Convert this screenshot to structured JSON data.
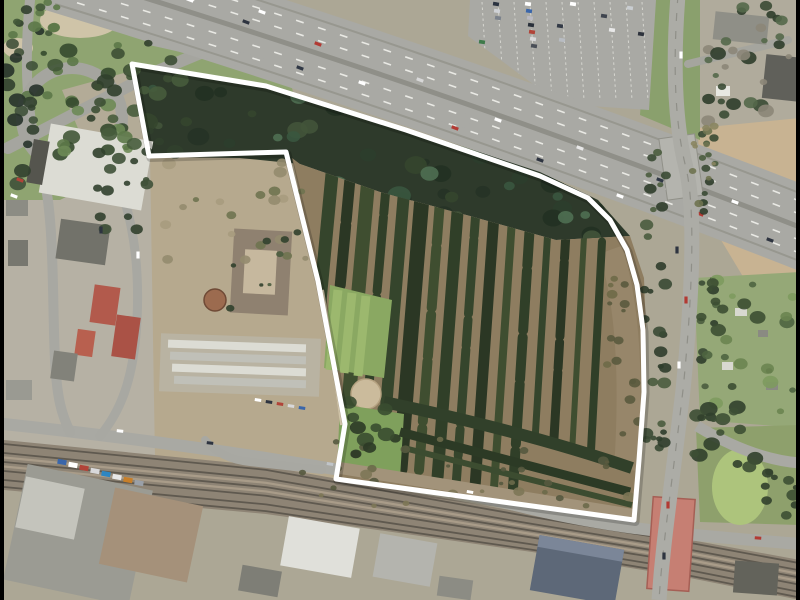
{
  "scene": {
    "type": "aerial-orthophoto",
    "description": "Aerial photo of a former tree-nursery site outlined with a white boundary, bordered by a motorway to the north, an arterial road to the east, a railway line to the south and an industrial quarter to the west",
    "boundary_color": "#ffffff",
    "letterbox_color": "#000000"
  },
  "colors": {
    "land": "#aca795",
    "urban": "#b6b1a4",
    "road": "#a9a9a3",
    "road_light": "#b4b4ae",
    "lane": "#e9e9e4",
    "highway": "#a9a9a4",
    "median": "#8f8f88",
    "edge": "#97978f",
    "rail_band": "#8e8475",
    "rail_track": "#5f594f",
    "rail_light": "#a99c89",
    "forest": "#2e3a2b",
    "soil": "#8e7d60",
    "scrub": "#b6a98e",
    "scrub_dark": "#a2937a",
    "grass": "#8fa471",
    "lawn": "#7fa05c",
    "lawn_bright": "#adc47c",
    "grass_row": "#9cb86e",
    "tan_field": "#c8b392",
    "allotment": "#95a877",
    "beige": "#cfc4a8",
    "parking": "#a9a9a4",
    "stall": "#d6d6d0",
    "red_bridge": "#c67f73",
    "red_bridge_edge": "#a55f55",
    "white_roof": "#dcdcd4",
    "gray_roof": "#9b9b93",
    "dark_roof": "#72726a",
    "red_roof": "#b25a4c",
    "blue_roof": "#5d6878",
    "demo_roof": "#a5917a",
    "court_roof": "#8f8170",
    "court_yard": "#c6b89e",
    "circle_sand": "#cbbb9c",
    "path": "#cfc3a8",
    "gravel": "#b3ab97"
  },
  "boundary": {
    "points": [
      [
        132,
        64
      ],
      [
        266,
        86
      ],
      [
        406,
        130
      ],
      [
        540,
        176
      ],
      [
        588,
        198
      ],
      [
        610,
        220
      ],
      [
        627,
        250
      ],
      [
        637,
        285
      ],
      [
        643,
        330
      ],
      [
        644,
        392
      ],
      [
        639,
        460
      ],
      [
        634,
        520
      ],
      [
        336,
        479
      ],
      [
        345,
        424
      ],
      [
        318,
        281
      ],
      [
        286,
        152
      ],
      [
        149,
        156
      ]
    ]
  },
  "highway": {
    "center_path": "M55,-30 C300,45 540,125 820,235",
    "width": 82,
    "dash_offsets": [
      -26,
      -13,
      13,
      26
    ],
    "edge_offsets": [
      -34,
      34
    ],
    "vehicles": [
      {
        "x": 190,
        "y": 0,
        "c": "#ffffff"
      },
      {
        "x": 246,
        "y": 22,
        "c": "#2e3440"
      },
      {
        "x": 262,
        "y": 12,
        "c": "#ffffff"
      },
      {
        "x": 318,
        "y": 44,
        "c": "#b23a33"
      },
      {
        "x": 300,
        "y": 68,
        "c": "#303845"
      },
      {
        "x": 362,
        "y": 83,
        "c": "#ffffff"
      },
      {
        "x": 420,
        "y": 80,
        "c": "#d8d8d8"
      },
      {
        "x": 455,
        "y": 128,
        "c": "#b23a33"
      },
      {
        "x": 498,
        "y": 120,
        "c": "#ffffff"
      },
      {
        "x": 540,
        "y": 160,
        "c": "#2e3440"
      },
      {
        "x": 580,
        "y": 148,
        "c": "#e8e8e8"
      },
      {
        "x": 620,
        "y": 196,
        "c": "#ffffff"
      },
      {
        "x": 660,
        "y": 180,
        "c": "#303845"
      },
      {
        "x": 700,
        "y": 214,
        "c": "#b23a33"
      },
      {
        "x": 735,
        "y": 202,
        "c": "#ffffff"
      },
      {
        "x": 770,
        "y": 240,
        "c": "#2e3440"
      }
    ]
  },
  "railway": {
    "north": [
      [
        4,
        440
      ],
      [
        266,
        466
      ],
      [
        532,
        514
      ],
      [
        680,
        538
      ],
      [
        800,
        560
      ]
    ],
    "south": [
      [
        4,
        490
      ],
      [
        266,
        514
      ],
      [
        532,
        552
      ],
      [
        680,
        576
      ],
      [
        800,
        600
      ]
    ],
    "dark_fractions": [
      0.08,
      0.26,
      0.44,
      0.62,
      0.8,
      0.94
    ],
    "light_fractions": [
      0.35,
      0.53
    ]
  },
  "nursery_rows": {
    "count": 16,
    "top": [
      332,
      174
    ],
    "top_step": [
      18.0,
      4.5
    ],
    "bot": [
      306,
      450
    ],
    "bot_step": [
      18.8,
      3.8
    ],
    "widths": [
      13,
      11,
      14,
      9,
      12,
      15,
      10,
      12,
      9,
      11,
      8,
      10,
      7,
      9,
      6,
      8
    ],
    "colors": [
      "#35452c",
      "#2b3724",
      "#3f4e30",
      "#303f28"
    ],
    "dashes": [
      "",
      "42 5 60 7",
      "",
      "26 4 74 6",
      ""
    ],
    "shorten_from": 12,
    "shorten_t": 0.78
  },
  "parking": {
    "polygon": [
      [
        470,
        0
      ],
      [
        656,
        0
      ],
      [
        649,
        110
      ],
      [
        560,
        104
      ],
      [
        468,
        36
      ]
    ],
    "columns": 11,
    "col_x0": 482,
    "col_step": 16,
    "col_skew": 6,
    "cars": [
      {
        "x": 528,
        "y": 4,
        "c": "#ffffff"
      },
      {
        "x": 529,
        "y": 11,
        "c": "#3a66aa"
      },
      {
        "x": 530,
        "y": 18,
        "c": "#b9b9c2"
      },
      {
        "x": 531,
        "y": 25,
        "c": "#29303a"
      },
      {
        "x": 532,
        "y": 32,
        "c": "#b14439"
      },
      {
        "x": 533,
        "y": 39,
        "c": "#d8d8da"
      },
      {
        "x": 534,
        "y": 46,
        "c": "#4a4f57"
      },
      {
        "x": 496,
        "y": 4,
        "c": "#2b3340"
      },
      {
        "x": 497,
        "y": 11,
        "c": "#cfd2d6"
      },
      {
        "x": 498,
        "y": 18,
        "c": "#7b828c"
      },
      {
        "x": 560,
        "y": 26,
        "c": "#333a46"
      },
      {
        "x": 562,
        "y": 40,
        "c": "#b8bcc2"
      },
      {
        "x": 573,
        "y": 4,
        "c": "#ffffff"
      },
      {
        "x": 604,
        "y": 16,
        "c": "#3f454f"
      },
      {
        "x": 630,
        "y": 8,
        "c": "#c9cdd1"
      },
      {
        "x": 641,
        "y": 34,
        "c": "#2e333d"
      },
      {
        "x": 482,
        "y": 42,
        "c": "#3f7a4a"
      },
      {
        "x": 612,
        "y": 30,
        "c": "#e8e8e8"
      }
    ]
  },
  "cars": [
    {
      "x": 681,
      "y": 55,
      "c": "#ffffff",
      "vert": true
    },
    {
      "x": 677,
      "y": 250,
      "c": "#2e3440",
      "vert": true
    },
    {
      "x": 686,
      "y": 300,
      "c": "#b23a33",
      "vert": true
    },
    {
      "x": 679,
      "y": 365,
      "c": "#ffffff",
      "vert": true
    },
    {
      "x": 668,
      "y": 505,
      "c": "#b23a33",
      "vert": true
    },
    {
      "x": 664,
      "y": 556,
      "c": "#2e3440",
      "vert": true
    },
    {
      "x": 120,
      "y": 431,
      "c": "#ffffff",
      "r": 6
    },
    {
      "x": 210,
      "y": 443,
      "c": "#2e3440",
      "r": 7
    },
    {
      "x": 330,
      "y": 464,
      "c": "#c0c4c8",
      "r": 9
    },
    {
      "x": 470,
      "y": 492,
      "c": "#ffffff",
      "r": 10
    },
    {
      "x": 758,
      "y": 538,
      "c": "#b23a33",
      "r": 5
    },
    {
      "x": 62,
      "y": 462,
      "c": "#3a66aa",
      "r": 10,
      "big": true
    },
    {
      "x": 73,
      "y": 465,
      "c": "#ffffff",
      "r": 10,
      "big": true
    },
    {
      "x": 84,
      "y": 468,
      "c": "#b14439",
      "r": 10,
      "big": true
    },
    {
      "x": 95,
      "y": 471,
      "c": "#d8d8da",
      "r": 10,
      "big": true
    },
    {
      "x": 106,
      "y": 474,
      "c": "#2e86c1",
      "r": 10,
      "big": true
    },
    {
      "x": 117,
      "y": 477,
      "c": "#e8e8e8",
      "r": 10,
      "big": true
    },
    {
      "x": 128,
      "y": 480,
      "c": "#c77f2a",
      "r": 10,
      "big": true
    },
    {
      "x": 139,
      "y": 483,
      "c": "#9aa0a8",
      "r": 10,
      "big": true
    },
    {
      "x": 258,
      "y": 400,
      "c": "#ffffff",
      "r": 8
    },
    {
      "x": 269,
      "y": 402,
      "c": "#2e3440",
      "r": 8
    },
    {
      "x": 280,
      "y": 404,
      "c": "#b14439",
      "r": 8
    },
    {
      "x": 291,
      "y": 406,
      "c": "#d8d8da",
      "r": 8
    },
    {
      "x": 302,
      "y": 408,
      "c": "#3a66aa",
      "r": 8
    },
    {
      "x": 20,
      "y": 180,
      "c": "#b14439",
      "r": -70,
      "vert": true
    },
    {
      "x": 14,
      "y": 196,
      "c": "#ffffff",
      "r": -70,
      "vert": true
    },
    {
      "x": 101,
      "y": 230,
      "c": "#2e3440",
      "vert": true
    },
    {
      "x": 138,
      "y": 255,
      "c": "#ffffff",
      "vert": true
    }
  ],
  "veg_clusters": [
    {
      "box": [
        140,
        62,
        495,
        180
      ],
      "n": 110,
      "rmin": 4,
      "rmax": 12,
      "clip": "clip-forest",
      "colors": [
        "#223122",
        "#2c3e2c",
        "#3a573f",
        "#42543a",
        "#263326",
        "#4f6f52",
        "#35462e"
      ]
    },
    {
      "box": [
        25,
        45,
        110,
        110
      ],
      "n": 26,
      "rmin": 3,
      "rmax": 9,
      "colors": [
        "#5c7848",
        "#415737",
        "#6d8a55",
        "#354a2e"
      ]
    },
    {
      "box": [
        2,
        5,
        38,
        185
      ],
      "n": 20,
      "rmin": 4,
      "rmax": 9,
      "colors": [
        "#31402e",
        "#3f5138",
        "#27332a"
      ]
    },
    {
      "box": [
        88,
        40,
        95,
        115
      ],
      "n": 24,
      "rmin": 4,
      "rmax": 9,
      "colors": [
        "#31402c",
        "#3d4f34",
        "#475c3c"
      ]
    },
    {
      "box": [
        644,
        150,
        22,
        360
      ],
      "n": 30,
      "rmin": 3,
      "rmax": 7,
      "colors": [
        "#3a4a34",
        "#4a5c3e",
        "#2f3d2b"
      ]
    },
    {
      "box": [
        700,
        130,
        16,
        290
      ],
      "n": 22,
      "rmin": 3,
      "rmax": 6,
      "colors": [
        "#3a4a34",
        "#4a5c3e",
        "#2f3d2b"
      ]
    },
    {
      "box": [
        696,
        276,
        100,
        148
      ],
      "n": 26,
      "rmin": 3,
      "rmax": 8,
      "colors": [
        "#4e6440",
        "#6a8450",
        "#3c4e32",
        "#7d9a5e"
      ]
    },
    {
      "box": [
        702,
        2,
        96,
        126
      ],
      "n": 30,
      "rmin": 3,
      "rmax": 8,
      "colors": [
        "#3b4b35",
        "#54684a",
        "#8c8678",
        "#2f3d2b"
      ]
    },
    {
      "box": [
        694,
        398,
        64,
        70
      ],
      "n": 14,
      "rmin": 4,
      "rmax": 9,
      "colors": [
        "#31402c",
        "#3d4f34"
      ]
    },
    {
      "box": [
        760,
        470,
        38,
        55
      ],
      "n": 10,
      "rmin": 3,
      "rmax": 7,
      "colors": [
        "#31402c",
        "#3d4f34"
      ]
    },
    {
      "box": [
        300,
        438,
        330,
        70
      ],
      "n": 30,
      "rmin": 2,
      "rmax": 6,
      "colors": [
        "#55593f",
        "#6b6a4a",
        "#7d7757"
      ]
    },
    {
      "box": [
        158,
        160,
        150,
        115
      ],
      "n": 20,
      "rmin": 3,
      "rmax": 7,
      "colors": [
        "#948b6e",
        "#6f7350",
        "#a79b7e"
      ]
    },
    {
      "box": [
        92,
        150,
        55,
        95
      ],
      "n": 14,
      "rmin": 3,
      "rmax": 7,
      "colors": [
        "#31402e",
        "#3f5138"
      ]
    },
    {
      "box": [
        342,
        402,
        62,
        74
      ],
      "n": 10,
      "rmin": 4,
      "rmax": 9,
      "colors": [
        "#2c3a26",
        "#3a4c30"
      ]
    },
    {
      "box": [
        692,
        118,
        26,
        95
      ],
      "n": 10,
      "rmin": 2,
      "rmax": 5,
      "colors": [
        "#8a8560",
        "#6f7350"
      ]
    },
    {
      "box": [
        0,
        0,
        60,
        40
      ],
      "n": 10,
      "rmin": 3,
      "rmax": 7,
      "colors": [
        "#5c7848",
        "#415737"
      ]
    },
    {
      "box": [
        230,
        225,
        70,
        95
      ],
      "n": 8,
      "rmin": 2,
      "rmax": 5,
      "colors": [
        "#31402c",
        "#4a5c3e"
      ]
    },
    {
      "box": [
        600,
        250,
        40,
        230
      ],
      "n": 18,
      "rmin": 2,
      "rmax": 6,
      "clip": "clip-nursery",
      "colors": [
        "#5a5a3e",
        "#6e6a48"
      ]
    }
  ]
}
